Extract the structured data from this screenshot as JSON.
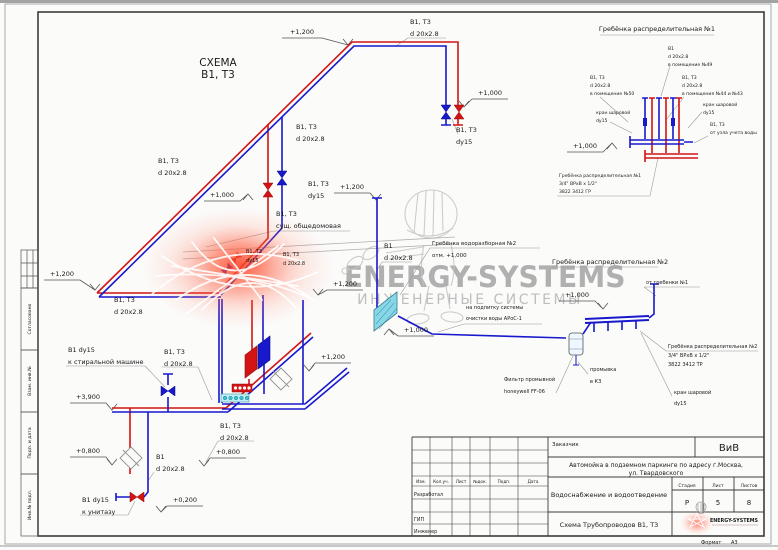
{
  "sheet": {
    "format_label": "Формат",
    "format_value": "А3"
  },
  "watermark": {
    "brand": "ENERGY-SYSTEMS",
    "subtitle": "ИНЖЕНЕРНЫЕ СИСТЕМЫ"
  },
  "frame_labels": {
    "agreed": "Согласовано",
    "replace_inv": "Взам. инв.№",
    "sign_date": "Подп. и дата",
    "inv_orig": "Инв.№ подл."
  },
  "title_block": {
    "customer_label": "Заказчик",
    "customer_value": "ВиВ",
    "project_line1": "Автомойка в подземном паркинге по адресу г.Москва,",
    "project_line2": "ул. Твардовского",
    "section_title": "Водоснабжение и водоотведение",
    "drawing_title": "Схема Трубопроводов В1, Т3",
    "stage_label": "Стадия",
    "stage_value": "Р",
    "sheet_label": "Лист",
    "sheet_value": "5",
    "sheets_label": "Листов",
    "sheets_value": "8",
    "columns": [
      "Изм.",
      "Кол.уч.",
      "Лист",
      "№док.",
      "Подп.",
      "Дата"
    ],
    "roles": [
      "Разработал",
      "ГИП",
      "Инженер"
    ],
    "logo_text": "ENERGY-SYSTEMS"
  },
  "colors": {
    "hot_pipe": "#d21414",
    "cold_pipe": "#1818cc",
    "intake_cyan": "#86d8e8",
    "stamp_glow": "#ff3c1e",
    "watermark_gray": "#9e9e9e"
  },
  "diagram": {
    "labels": [
      {
        "lines": [
          "СХЕМА",
          "В1, Т3"
        ],
        "x": 218,
        "y": 66,
        "ha": "middle",
        "size": 10.5,
        "lh": 12,
        "name": "schema-title"
      },
      {
        "lines": [
          "+1,200"
        ],
        "x": 302,
        "y": 34,
        "ha": "middle",
        "name": "elevation-label"
      },
      {
        "lines": [
          "В1, Т3",
          "d 20x2.8"
        ],
        "x": 410,
        "y": 24,
        "name": "pipe-label"
      },
      {
        "lines": [
          "+1,000"
        ],
        "x": 490,
        "y": 95,
        "ha": "middle",
        "name": "elevation-label"
      },
      {
        "lines": [
          "В1, Т3",
          "dy15"
        ],
        "x": 456,
        "y": 132,
        "name": "pipe-label"
      },
      {
        "lines": [
          "В1, Т3",
          "d 20x2.8"
        ],
        "x": 158,
        "y": 163,
        "name": "pipe-label"
      },
      {
        "lines": [
          "В1, Т3",
          "d 20x2.8"
        ],
        "x": 296,
        "y": 129,
        "name": "pipe-label"
      },
      {
        "lines": [
          "В1, Т3",
          "dy15"
        ],
        "x": 308,
        "y": 186,
        "name": "pipe-label"
      },
      {
        "lines": [
          "+1,000"
        ],
        "x": 222,
        "y": 197,
        "ha": "middle",
        "name": "elevation-label"
      },
      {
        "lines": [
          "+1,200"
        ],
        "x": 352,
        "y": 189,
        "ha": "middle",
        "name": "elevation-label"
      },
      {
        "lines": [
          "В1, Т3",
          "сущ. общедомовая"
        ],
        "x": 276,
        "y": 216,
        "name": "callout-label"
      },
      {
        "lines": [
          "+1,200"
        ],
        "x": 62,
        "y": 276,
        "ha": "middle",
        "name": "elevation-label"
      },
      {
        "lines": [
          "В1, Т3",
          "d 20x2.8"
        ],
        "x": 114,
        "y": 302,
        "name": "pipe-label"
      },
      {
        "lines": [
          "В1, Т3",
          "dy15"
        ],
        "x": 246,
        "y": 253,
        "size": 5,
        "lh": 9,
        "name": "pipe-label"
      },
      {
        "lines": [
          "В1, Т3",
          "d 20x2.8"
        ],
        "x": 283,
        "y": 256,
        "size": 5,
        "lh": 9,
        "name": "pipe-label"
      },
      {
        "lines": [
          "+1,200"
        ],
        "x": 345,
        "y": 286,
        "ha": "middle",
        "name": "elevation-label"
      },
      {
        "lines": [
          "В1",
          "d 20x2.8"
        ],
        "x": 384,
        "y": 248,
        "name": "pipe-label"
      },
      {
        "lines": [
          "Гребёнка водоразборная №2",
          "отм. +1,000"
        ],
        "x": 432,
        "y": 245,
        "size": 5.5,
        "name": "manifold-intake-title"
      },
      {
        "lines": [
          "+1,000"
        ],
        "x": 416,
        "y": 332,
        "ha": "middle",
        "name": "elevation-label"
      },
      {
        "lines": [
          "на подпитку системы",
          "очистки воды АРоС-1"
        ],
        "x": 466,
        "y": 309,
        "size": 5,
        "lh": 11,
        "name": "callout-label"
      },
      {
        "lines": [
          "+1,200"
        ],
        "x": 333,
        "y": 359,
        "ha": "middle",
        "name": "elevation-label"
      },
      {
        "lines": [
          "Гребёнка распределительная №2"
        ],
        "x": 552,
        "y": 264,
        "size": 6.5,
        "name": "manifold2-title"
      },
      {
        "lines": [
          "от гребенки №1"
        ],
        "x": 646,
        "y": 284,
        "size": 5,
        "name": "callout-label"
      },
      {
        "lines": [
          "+1,000"
        ],
        "x": 577,
        "y": 297,
        "ha": "middle",
        "name": "elevation-label"
      },
      {
        "lines": [
          "Гребёнка распределительная №2",
          "3/4\" ВРхВ х 1/2\"",
          "3822 3412 ТР"
        ],
        "x": 668,
        "y": 348,
        "size": 5,
        "lh": 9,
        "name": "callout-label"
      },
      {
        "lines": [
          "кран шаровой",
          "dy15"
        ],
        "x": 674,
        "y": 394,
        "size": 5,
        "lh": 11,
        "name": "callout-label"
      },
      {
        "lines": [
          "промывка",
          "в КЗ"
        ],
        "x": 590,
        "y": 371,
        "size": 5,
        "lh": 12,
        "name": "callout-label"
      },
      {
        "lines": [
          "Фильтр промывной",
          "honeywell FF-06"
        ],
        "x": 504,
        "y": 381,
        "size": 5,
        "lh": 12,
        "name": "callout-label"
      },
      {
        "lines": [
          "Гребёнка распределительная №1"
        ],
        "x": 657,
        "y": 31,
        "ha": "middle",
        "size": 6.5,
        "name": "manifold1-title"
      },
      {
        "lines": [
          "В1",
          "d 20x2.8",
          "в помещение №49"
        ],
        "x": 668,
        "y": 50,
        "size": 4.6,
        "lh": 8,
        "name": "callout-label"
      },
      {
        "lines": [
          "В1, Т3",
          "d 20x2.8",
          "в помещение №50"
        ],
        "x": 590,
        "y": 79,
        "size": 4.6,
        "lh": 8,
        "name": "callout-label"
      },
      {
        "lines": [
          "В1, Т3",
          "d 20x2.8",
          "в помещения №44 и №43"
        ],
        "x": 682,
        "y": 79,
        "size": 4.6,
        "lh": 8,
        "name": "callout-label"
      },
      {
        "lines": [
          "кран шаровой",
          "dy15"
        ],
        "x": 596,
        "y": 114,
        "size": 4.6,
        "lh": 8,
        "name": "callout-label"
      },
      {
        "lines": [
          "кран шаровой",
          "dy15"
        ],
        "x": 703,
        "y": 106,
        "size": 4.6,
        "lh": 8,
        "name": "callout-label"
      },
      {
        "lines": [
          "В1, Т3",
          "от узла учета воды"
        ],
        "x": 710,
        "y": 126,
        "size": 4.6,
        "lh": 8,
        "name": "callout-label"
      },
      {
        "lines": [
          "+1,000"
        ],
        "x": 585,
        "y": 148,
        "ha": "middle",
        "name": "elevation-label"
      },
      {
        "lines": [
          "Гребёнка распределительная №1",
          "3/4\" ВРхВ х 1/2\"",
          "3822 3412 ГР"
        ],
        "x": 559,
        "y": 177,
        "size": 4.6,
        "lh": 8,
        "name": "callout-label"
      },
      {
        "lines": [
          "В1    dy15",
          "к стиральной машине"
        ],
        "x": 68,
        "y": 352,
        "lh": 12,
        "name": "callout-label"
      },
      {
        "lines": [
          "В1, Т3",
          "d 20x2.8"
        ],
        "x": 164,
        "y": 354,
        "lh": 12,
        "name": "pipe-label"
      },
      {
        "lines": [
          "+3,900"
        ],
        "x": 88,
        "y": 399,
        "ha": "middle",
        "name": "elevation-label"
      },
      {
        "lines": [
          "+0,800"
        ],
        "x": 88,
        "y": 453,
        "ha": "middle",
        "name": "elevation-label"
      },
      {
        "lines": [
          "+0,800"
        ],
        "x": 228,
        "y": 454,
        "ha": "middle",
        "name": "elevation-label"
      },
      {
        "lines": [
          "В1",
          "d 20x2.8"
        ],
        "x": 156,
        "y": 459,
        "lh": 12,
        "name": "pipe-label"
      },
      {
        "lines": [
          "В1, Т3",
          "d 20x2.8"
        ],
        "x": 220,
        "y": 428,
        "lh": 12,
        "name": "pipe-label"
      },
      {
        "lines": [
          "В1    dy15",
          "к унитазу"
        ],
        "x": 82,
        "y": 502,
        "lh": 12,
        "name": "callout-label"
      },
      {
        "lines": [
          "+0,200"
        ],
        "x": 185,
        "y": 502,
        "ha": "middle",
        "name": "elevation-label"
      }
    ]
  }
}
